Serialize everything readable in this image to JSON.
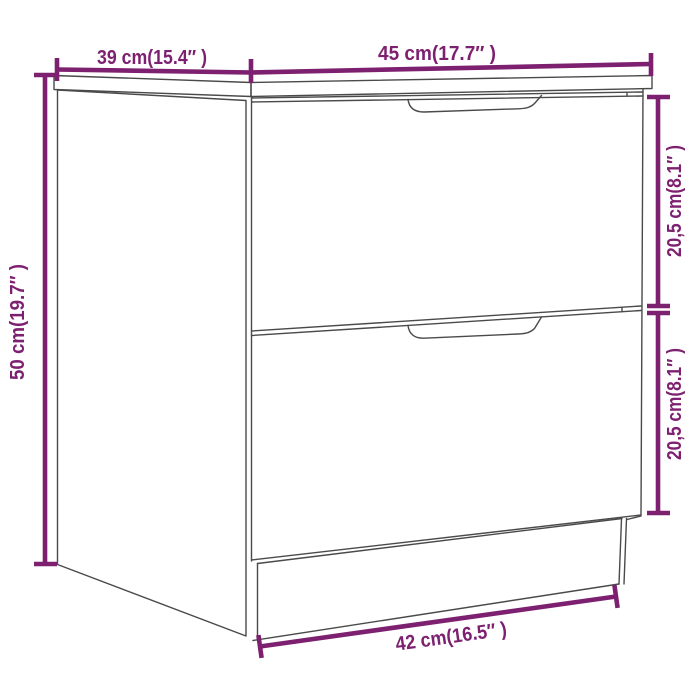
{
  "diagram": {
    "kind": "product dimension line drawing",
    "subject": "bedside cabinet with two drawers",
    "background_color": "#ffffff",
    "accent_color": "#7d2070",
    "outline_color": "#4a4a4a",
    "dimensions": {
      "top_depth": "39 cm(15.4″ )",
      "top_width": "45 cm(17.7″ )",
      "left_height": "50 cm(19.7″ )",
      "upper_drawer_height": "20,5 cm(8.1″ )",
      "lower_drawer_height": "20,5 cm(8.1″ )",
      "base_width": "42 cm(16.5″ )"
    }
  }
}
